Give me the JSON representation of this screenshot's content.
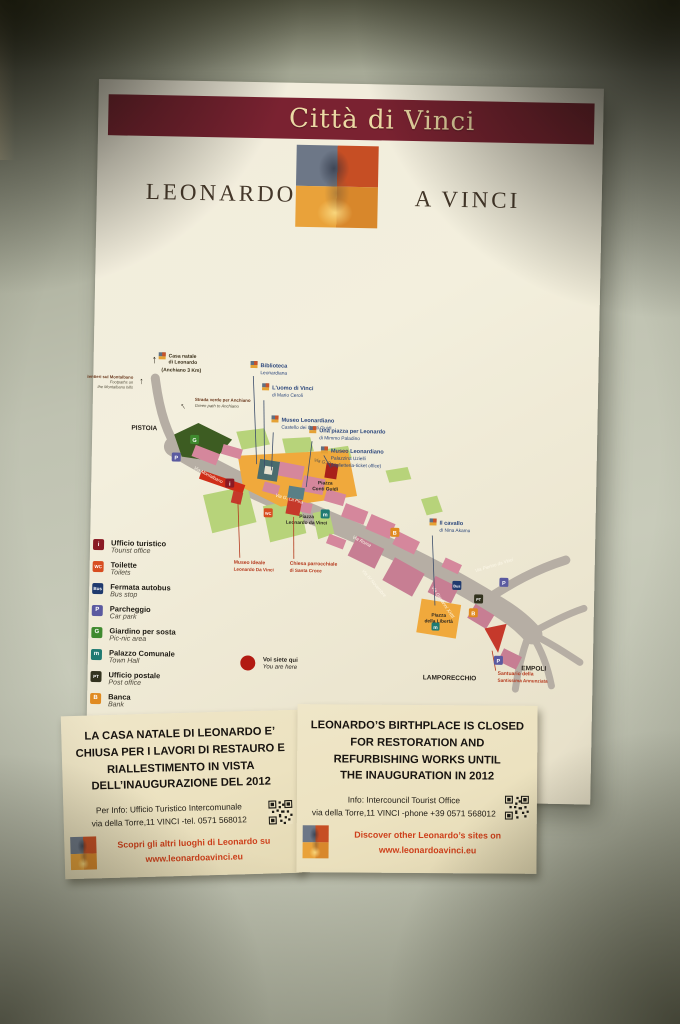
{
  "header": {
    "banner_title": "Città di Vinci",
    "brand_left": "LEONARDO",
    "brand_right": "A VINCI"
  },
  "map": {
    "directions": {
      "up_arrow": "↑",
      "casa_line1": "Casa natale",
      "casa_line2": "di Leonardo",
      "casa_line3": "(Anchiano 3 Km)",
      "montalbano_line1": "Sentieri sul Montalbano",
      "montalbano_line2": "Footpaths on",
      "montalbano_line3": "the Montalbano hills",
      "anchiano_line1": "Strada verde per Anchiano",
      "anchiano_line2": "Green path to Anchiano"
    },
    "towns": {
      "pistoia": "PISTOIA",
      "lamporecchio": "LAMPORECCHIO",
      "empoli": "EMPOLI"
    },
    "streets": {
      "rossi": "Via G. Rossi",
      "la_pira": "Via G. La Pira",
      "roma": "Via Roma",
      "novembre": "Via IV Novembre",
      "pierino": "Via Pierino da Vinci",
      "giovanni": "Via Giovanni XXIII",
      "montalbano": "Via Montalbano"
    },
    "piazzas": {
      "conti_guidi_line1": "Piazza",
      "conti_guidi_line2": "Conti Guidi",
      "leonardo_line1": "Piazza",
      "leonardo_line2": "Leonardo da Vinci",
      "liberta_line1": "Piazza",
      "liberta_line2": "della Libertà"
    },
    "poi": [
      {
        "line1": "Biblioteca",
        "line2": "Leonardiana"
      },
      {
        "line1": "L'uomo di Vinci",
        "line2": "di Mario Ceroli"
      },
      {
        "line1": "Museo Leonardiano",
        "line2": "Castello dei Conti Guidi"
      },
      {
        "line1": "Una piazza per Leonardo",
        "line2": "di Mimmo Paladino"
      },
      {
        "line1": "Museo Leonardiano",
        "line2": "Palazzina Uzielli",
        "line3": "(biglietteria-ticket office)"
      },
      {
        "line1": "Il cavallo",
        "line2": "di Nina Akamu"
      }
    ],
    "poi_red": [
      {
        "line1": "Museo Ideale",
        "line2": "Leonardo Da Vinci"
      },
      {
        "line1": "Chiesa parrocchiale",
        "line2": "di Santa Croce"
      },
      {
        "line1": "Santuario della",
        "line2": "Santissima Annunziata"
      }
    ],
    "you_are_here": {
      "it": "Voi siete qui",
      "en": "You are here"
    }
  },
  "legend": {
    "items": [
      {
        "icon": "i",
        "color": "#8a1a24",
        "it": "Ufficio turistico",
        "en": "Tourist office"
      },
      {
        "icon": "WC",
        "color": "#d84d20",
        "it": "Toilette",
        "en": "Toilets"
      },
      {
        "icon": "Bus",
        "color": "#1f3a6e",
        "it": "Fermata autobus",
        "en": "Bus stop"
      },
      {
        "icon": "P",
        "color": "#5a5aa0",
        "it": "Parcheggio",
        "en": "Car park"
      },
      {
        "icon": "G",
        "color": "#3f8a2f",
        "it": "Giardino per sosta",
        "en": "Pic-nic area"
      },
      {
        "icon": "m",
        "color": "#1f7a72",
        "it": "Palazzo Comunale",
        "en": "Town Hall"
      },
      {
        "icon": "PT",
        "color": "#33331f",
        "it": "Ufficio postale",
        "en": "Post office"
      },
      {
        "icon": "B",
        "color": "#e08a20",
        "it": "Banca",
        "en": "Bank"
      }
    ]
  },
  "notices": {
    "italian": {
      "title": "LA CASA NATALE DI LEONARDO E’\nCHIUSA PER I LAVORI DI RESTAURO E\nRIALLESTIMENTO IN VISTA\nDELL’INAUGURAZIONE DEL 2012",
      "info": "Per Info: Ufficio Turistico Intercomunale\nvia della Torre,11 VINCI -tel. 0571 568012",
      "footer": "Scopri gli altri luoghi di Leonardo su\nwww.leonardoavinci.eu"
    },
    "english": {
      "title": "LEONARDO’S BIRTHPLACE IS CLOSED\nFOR RESTORATION AND\nREFURBISHING WORKS UNTIL\nTHE INAUGURATION IN 2012",
      "info": "Info: Intercouncil Tourist Office\nvia della Torre,11 VINCI -phone +39 0571 568012",
      "footer": "Discover other Leonardo’s sites on\nwww.leonardoavinci.eu"
    }
  },
  "colors": {
    "banner": "#7a2231",
    "map_road": "#b6aea4",
    "map_orange": "#f0a93c",
    "map_pink": "#d5879c",
    "map_mauve": "#c77e93",
    "map_red": "#c5392b",
    "map_green_light": "#b7d37a",
    "map_green_dark": "#3d5c22",
    "poi_text": "#2c477c",
    "red_label": "#b53a1e",
    "notice_red": "#cd3f1a"
  }
}
